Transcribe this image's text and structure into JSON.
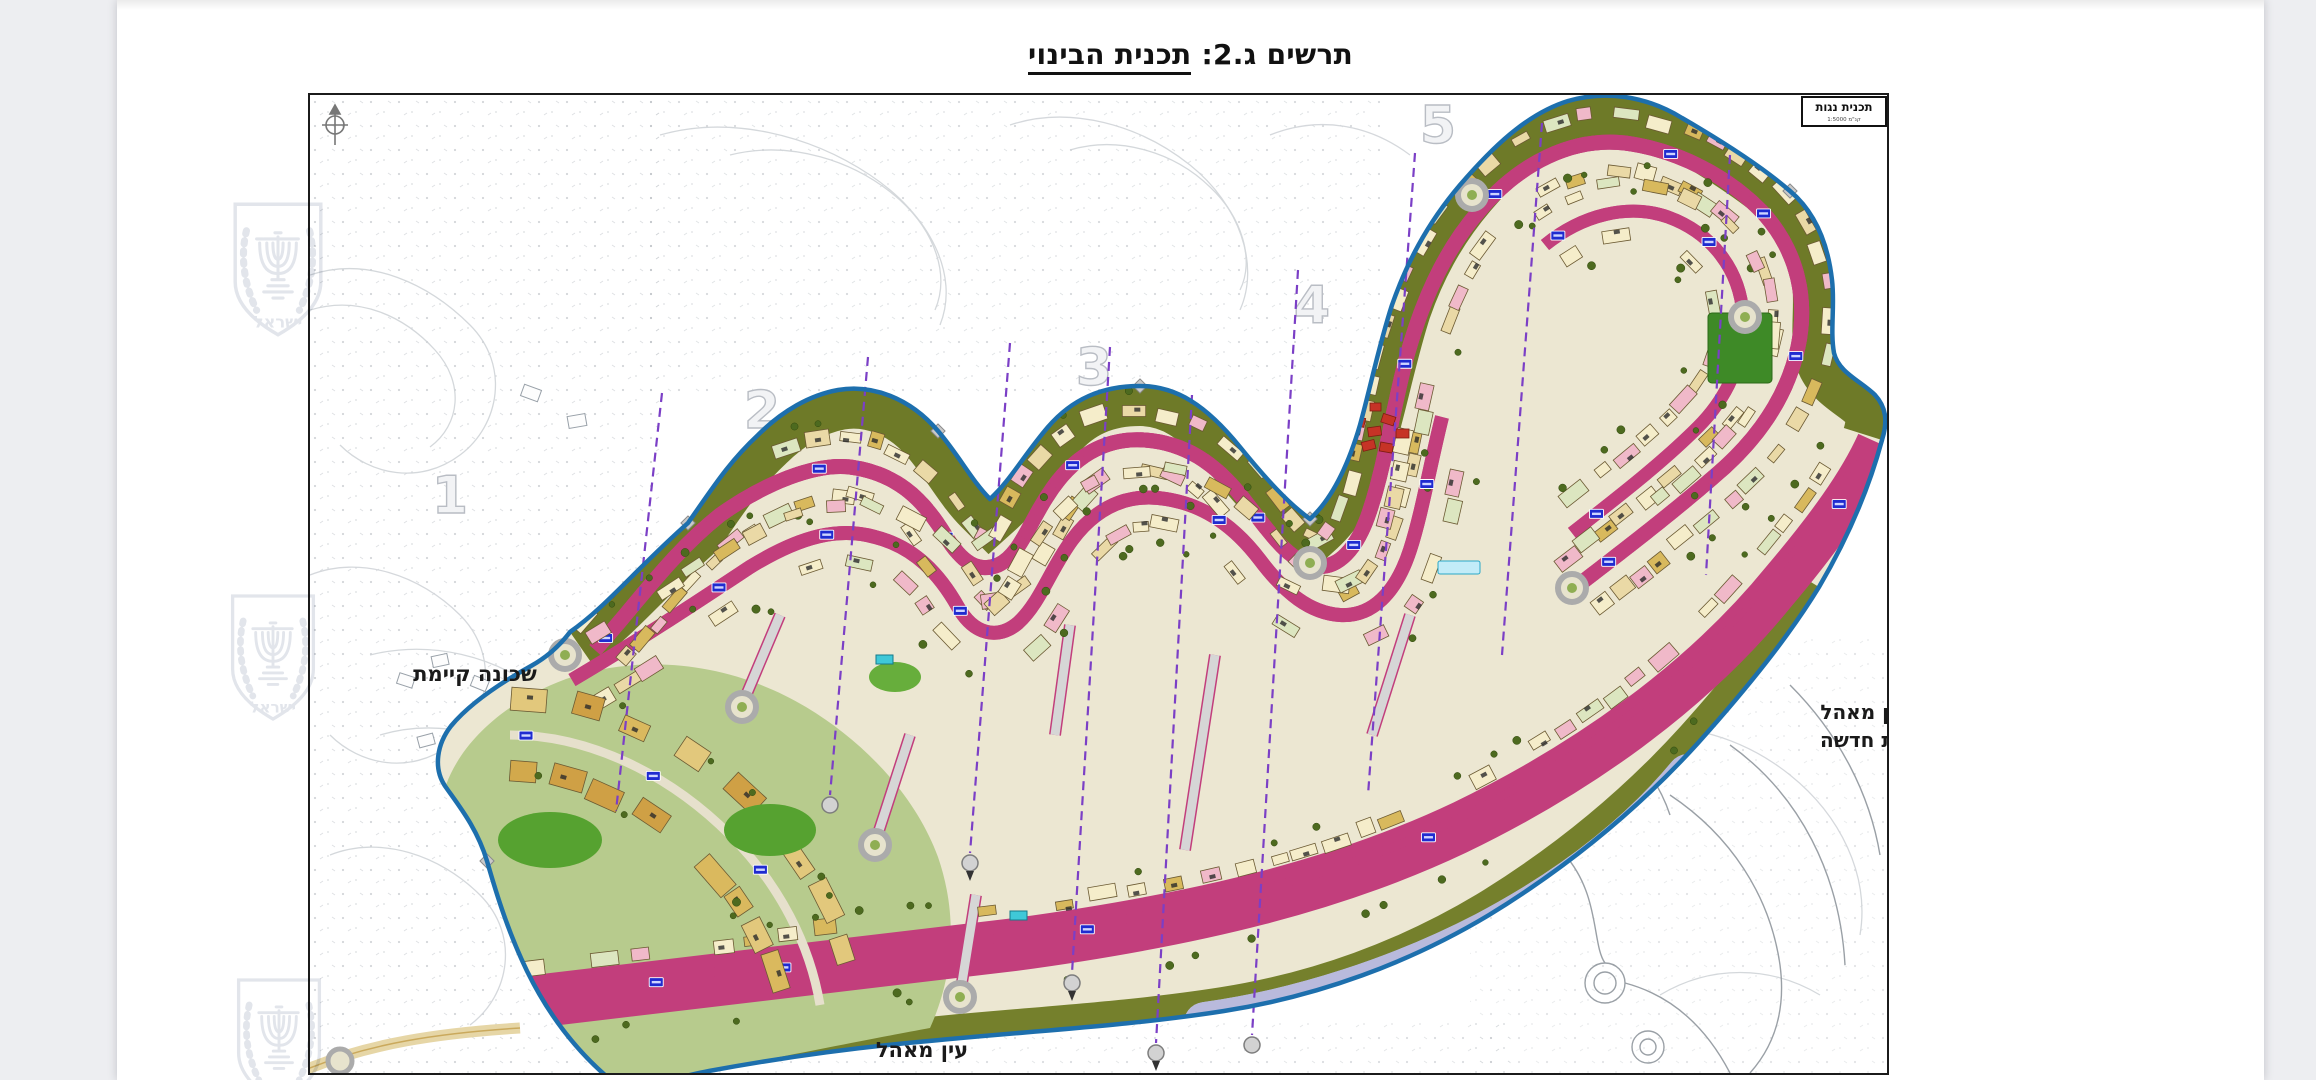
{
  "viewer": {
    "canvas_bg": "#edeef1",
    "page_bg": "#ffffff"
  },
  "title": {
    "prefix": "תרשים ג.2: ",
    "main": "תכנית הבינוי"
  },
  "map": {
    "corner_box": {
      "line1": "תכנית נגות",
      "line2": "קנ\"מ 1:5000"
    },
    "labels": {
      "left": "שכונה קיימת",
      "right_line1": "נין מאהל",
      "right_line2": "נית חדשה",
      "bottom": "עין מאהל"
    },
    "phase_numbers": [
      "1",
      "2",
      "3",
      "4",
      "5"
    ],
    "colors": {
      "boundary_blue": "#1d6fad",
      "open_space_olive": "#6e7a28",
      "road_edge_magenta": "#c23e7c",
      "section_line_purple": "#7b3fc6",
      "parcel_cream": "#f5edca",
      "parcel_tan": "#d8b95d",
      "parcel_pink": "#f0b9c9",
      "parcel_lavender": "#b9badc",
      "park_green": "#4f9a2f",
      "strip_green": "#54d87a",
      "label_chip_blue": "#1f2bd0",
      "contour_gray": "#d0d4d8"
    }
  },
  "watermark": {
    "text": "ישראל"
  }
}
